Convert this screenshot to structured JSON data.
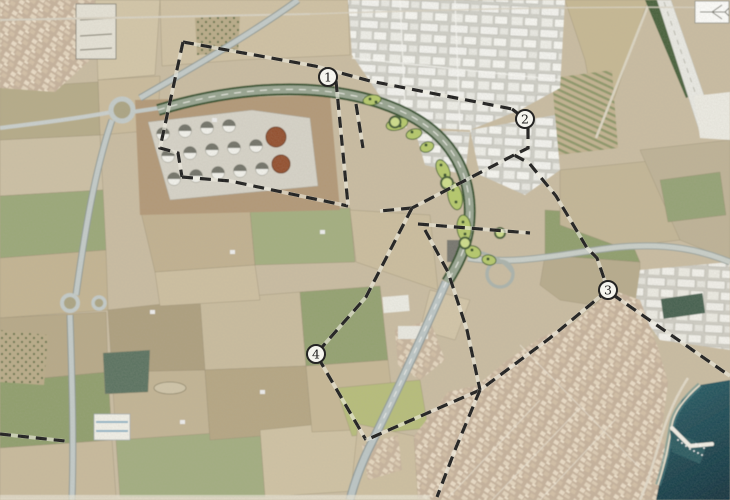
{
  "map": {
    "markers": [
      {
        "label": "1",
        "x": 328,
        "y": 77
      },
      {
        "label": "2",
        "x": 525,
        "y": 119
      },
      {
        "label": "3",
        "x": 608,
        "y": 290
      },
      {
        "label": "4",
        "x": 316,
        "y": 354
      }
    ],
    "marker_style": {
      "shape": "circle",
      "radius": 9,
      "fill": "#fcfcf6",
      "stroke": "#161616"
    },
    "boundaries": [
      {
        "name": "zone-1-north-edge",
        "points": "183,42 315,66 370,81 512,109"
      },
      {
        "name": "zone-1-west-edge",
        "points": "183,42 160,148 178,153 182,177"
      },
      {
        "name": "zone-1-south-edge",
        "points": "182,177 230,181 348,206"
      },
      {
        "name": "zone-1-east-edge",
        "points": "336,81 348,205"
      },
      {
        "name": "zone-1-east-edge-parallel",
        "points": "356,104 363,148"
      },
      {
        "name": "zone-2-corner-link",
        "points": "512,109 525,119"
      },
      {
        "name": "zone-2-east-edge",
        "points": "528,128 528,148 514,155 529,163 556,196 587,248 597,258 608,290"
      },
      {
        "name": "zone-2-west-diagonal",
        "points": "514,155 412,208"
      },
      {
        "name": "zone-4-north-stub",
        "points": "412,208 380,211"
      },
      {
        "name": "zone-4-west-edge",
        "points": "412,208 366,297 316,354 366,440"
      },
      {
        "name": "zone-3-southwest-edge",
        "points": "608,290 550,338 480,390 366,440"
      },
      {
        "name": "zone-3-southeast-edge",
        "points": "612,294 730,376"
      },
      {
        "name": "zone-4-east-edge",
        "points": "425,230 448,272 467,330 480,390"
      },
      {
        "name": "zone-4-south-exit",
        "points": "480,390 455,450 437,497"
      },
      {
        "name": "interchange-cross-line",
        "points": "418,224 530,233"
      },
      {
        "name": "west-edge-stub",
        "points": "0,434 65,441"
      }
    ],
    "boundary_style": {
      "color": "#1c1c1c",
      "dash": "11 7",
      "width": 3.2
    },
    "colors": {
      "sea": "#2a5f68",
      "sea_deep": "#11323e",
      "runway": "#e9e9e3",
      "runway_green_strip": "#47603a",
      "project_road_casing": "#33502c",
      "project_road_surface": "#97a490",
      "landscape_green": "#b5c96b",
      "tank_brown": "#93502d",
      "field_tan": "#c9bca1"
    },
    "icons": {
      "airplane": "airplane-outline"
    }
  }
}
